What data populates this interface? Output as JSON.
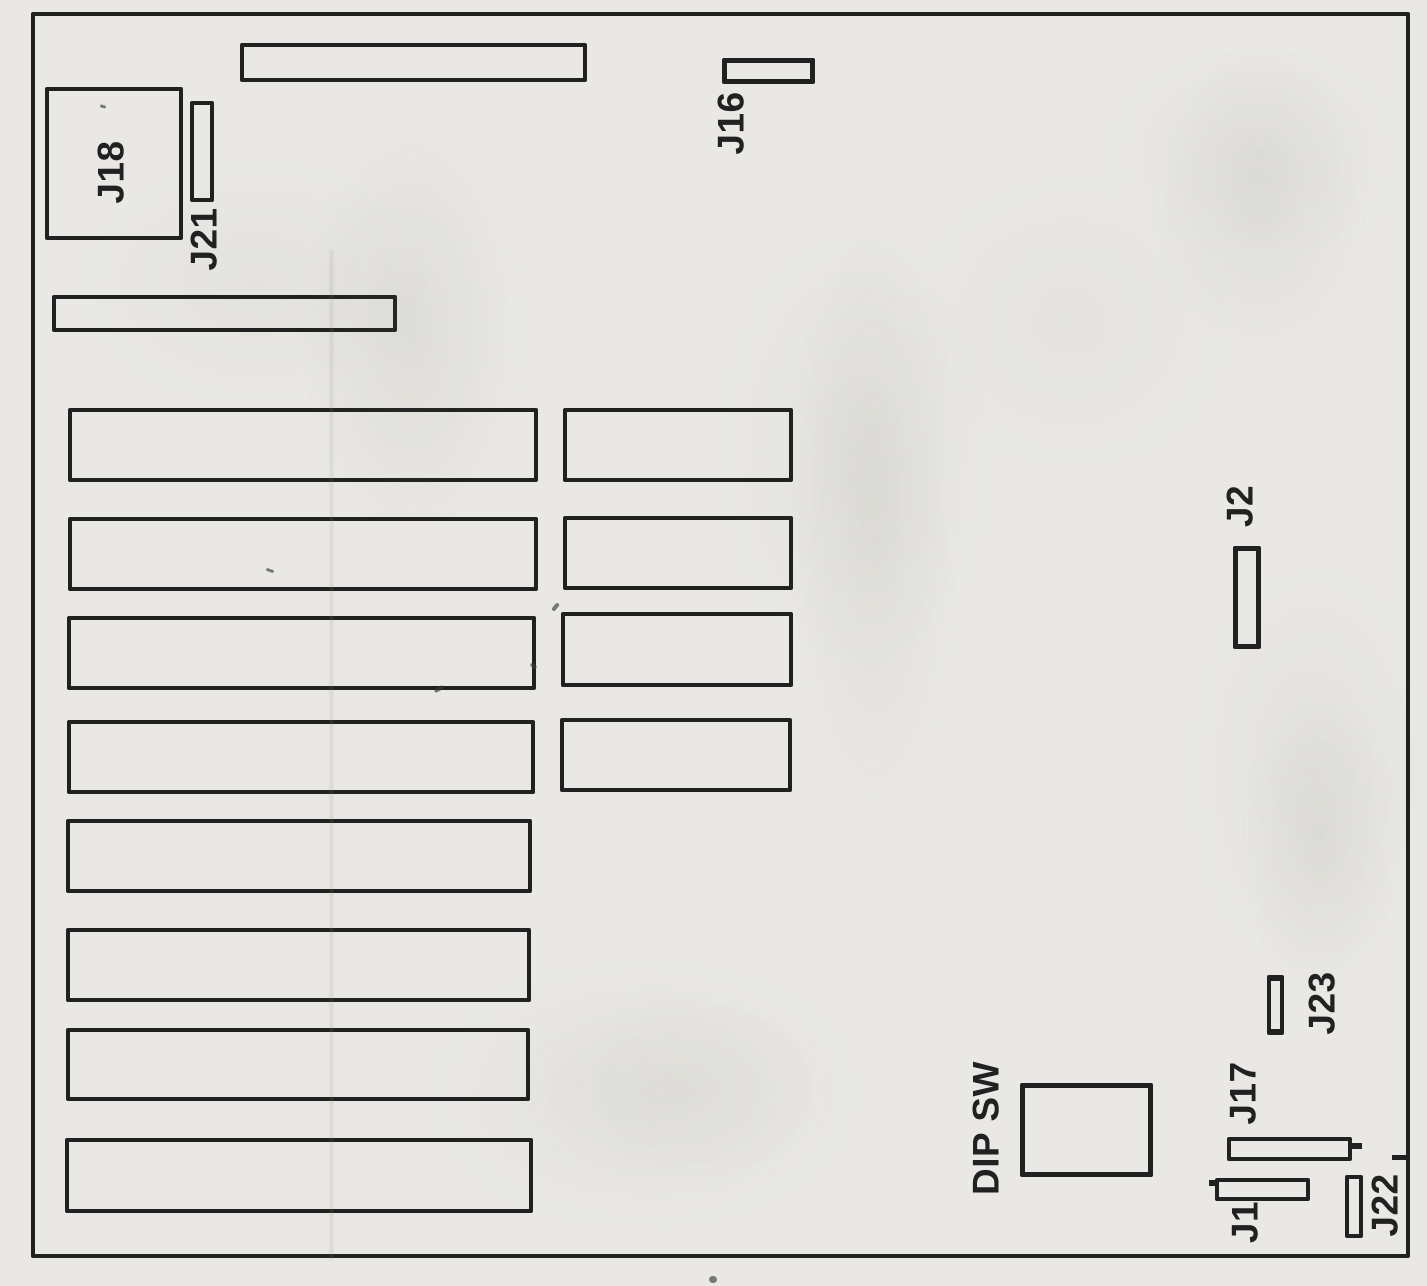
{
  "page": {
    "paper_color": "#e9e8e4",
    "ink_color": "#212121"
  },
  "labels": {
    "j18": "J18",
    "j21": "J21",
    "j16": "J16",
    "j2": "J2",
    "j23": "J23",
    "j17": "J17",
    "j1": "J1",
    "j22": "J22",
    "dip_sw": "DIP SW"
  }
}
